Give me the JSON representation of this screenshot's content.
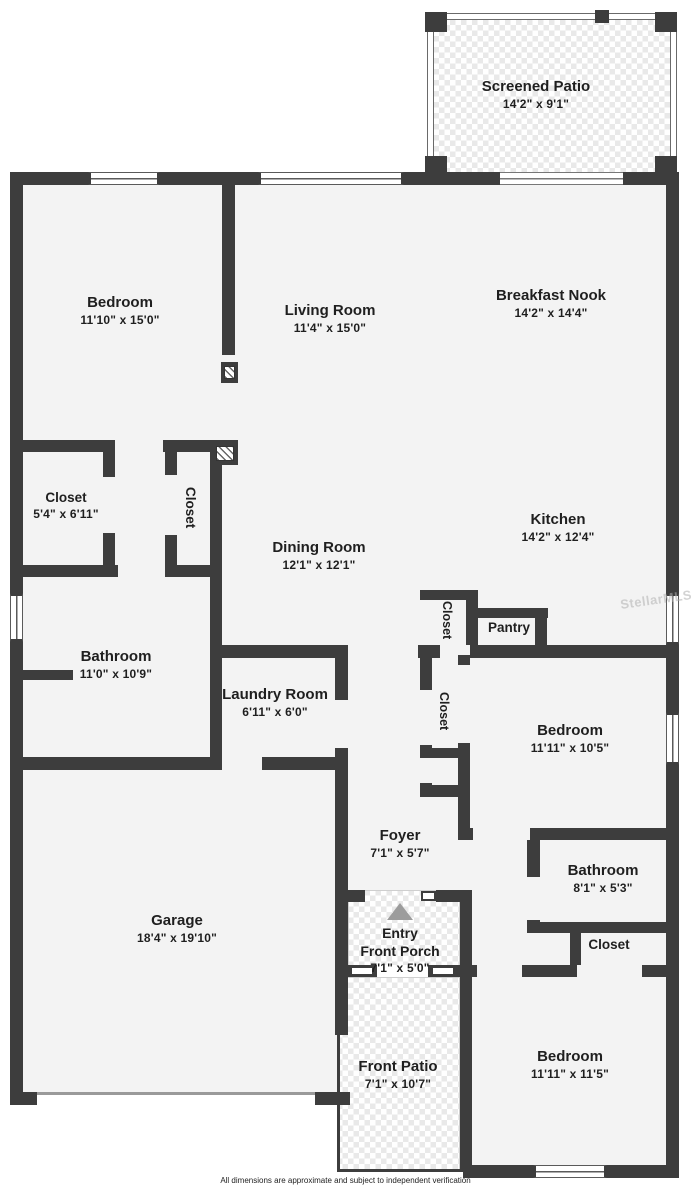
{
  "page": {
    "footer": "All dimensions are approximate and subject to independent verification",
    "watermark": "StellarMLS"
  },
  "colors": {
    "wall": "#3d3d3d",
    "room_fill": "#f3f3f3",
    "label_text": "#1f1f1f",
    "entry_arrow": "#9c9c9c",
    "watermark": "#b8b8b8"
  },
  "rooms": {
    "screened_patio": {
      "name": "Screened Patio",
      "dims": "14'2\" x 9'1\""
    },
    "bedroom_top": {
      "name": "Bedroom",
      "dims": "11'10\" x 15'0\""
    },
    "living_room": {
      "name": "Living Room",
      "dims": "11'4\" x 15'0\""
    },
    "breakfast_nook": {
      "name": "Breakfast Nook",
      "dims": "14'2\" x 14'4\""
    },
    "closet_master": {
      "name": "Closet",
      "dims": "5'4\" x 6'11\""
    },
    "closet_hall_left": {
      "name": "Closet"
    },
    "dining_room": {
      "name": "Dining Room",
      "dims": "12'1\" x 12'1\""
    },
    "kitchen": {
      "name": "Kitchen",
      "dims": "14'2\" x 12'4\""
    },
    "closet_kitchen": {
      "name": "Closet"
    },
    "pantry": {
      "name": "Pantry"
    },
    "bathroom_main": {
      "name": "Bathroom",
      "dims": "11'0\" x 10'9\""
    },
    "laundry": {
      "name": "Laundry Room",
      "dims": "6'11\" x 6'0\""
    },
    "closet_hall_mid": {
      "name": "Closet"
    },
    "bedroom_mid": {
      "name": "Bedroom",
      "dims": "11'11\" x 10'5\""
    },
    "foyer": {
      "name": "Foyer",
      "dims": "7'1\" x 5'7\""
    },
    "bathroom_2": {
      "name": "Bathroom",
      "dims": "8'1\" x 5'3\""
    },
    "garage": {
      "name": "Garage",
      "dims": "18'4\" x 19'10\""
    },
    "entry": {
      "name": "Entry"
    },
    "front_porch": {
      "name": "Front Porch",
      "dims": "7'1\" x 5'0\""
    },
    "closet_bedroom3": {
      "name": "Closet"
    },
    "front_patio": {
      "name": "Front Patio",
      "dims": "7'1\" x 10'7\""
    },
    "bedroom_bottom": {
      "name": "Bedroom",
      "dims": "11'11\" x 11'5\""
    }
  }
}
